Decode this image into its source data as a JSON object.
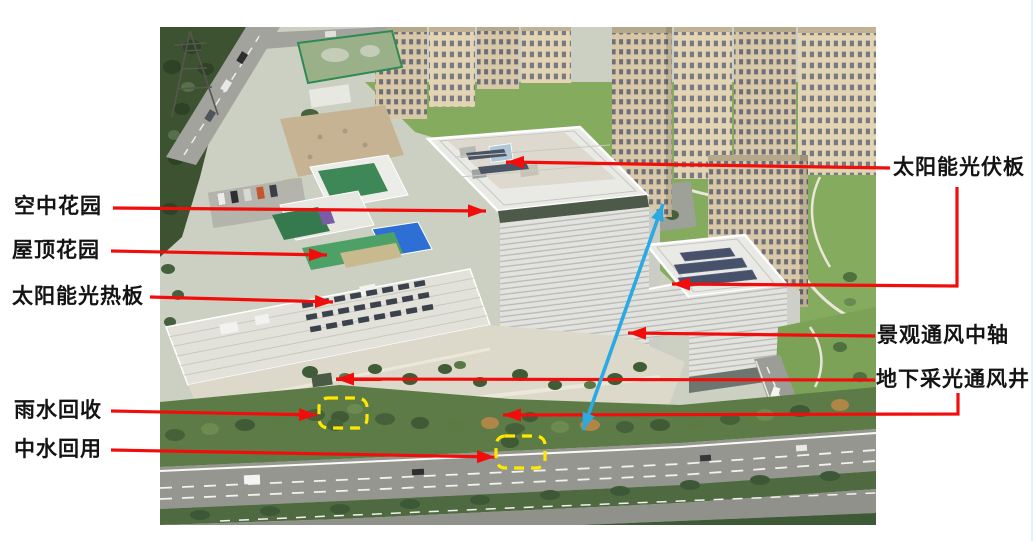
{
  "page": {
    "width": 1035,
    "height": 541,
    "background": "#ffffff"
  },
  "photo": {
    "left": 160,
    "top": 27,
    "width": 716,
    "height": 498,
    "description": "Oblique aerial photo of a green office complex: white louvered office tower and annex with rooftop solar panels, podium with roof gardens, residential high-rises behind, landscaped plaza and boulevard in front"
  },
  "colors": {
    "annotation_red": "#f20d0d",
    "annotation_blue": "#2aa9e2",
    "highlight_yellow": "#ffe800",
    "label_text": "#141414"
  },
  "labels": {
    "left": [
      {
        "id": "sky-garden",
        "text": "空中花园",
        "x": 14,
        "y": 194
      },
      {
        "id": "roof-garden",
        "text": "屋顶花园",
        "x": 12,
        "y": 238
      },
      {
        "id": "solar-thermal",
        "text": "太阳能光热板",
        "x": 12,
        "y": 284
      },
      {
        "id": "rainwater",
        "text": "雨水回收",
        "x": 14,
        "y": 398
      },
      {
        "id": "reclaimed-water",
        "text": "中水回用",
        "x": 14,
        "y": 437
      }
    ],
    "right": [
      {
        "id": "solar-pv",
        "text": "太阳能光伏板",
        "x": 893,
        "y": 155
      },
      {
        "id": "vent-axis",
        "text": "景观通风中轴",
        "x": 877,
        "y": 323
      },
      {
        "id": "daylight-shaft",
        "text": "地下采光通风井",
        "x": 876,
        "y": 367
      }
    ]
  },
  "annotations": {
    "leader_lines": [
      {
        "name": "leader-sky-garden",
        "points": [
          [
            113,
            208
          ],
          [
            486,
            211
          ]
        ]
      },
      {
        "name": "leader-roof-garden",
        "points": [
          [
            111,
            251
          ],
          [
            327,
            255
          ]
        ]
      },
      {
        "name": "leader-solar-thermal",
        "points": [
          [
            150,
            297
          ],
          [
            333,
            302
          ]
        ]
      },
      {
        "name": "leader-rainwater",
        "points": [
          [
            111,
            411
          ],
          [
            317,
            415
          ]
        ]
      },
      {
        "name": "leader-reclaimed-water",
        "points": [
          [
            111,
            450
          ],
          [
            495,
            457
          ]
        ]
      },
      {
        "name": "leader-solar-pv-tower",
        "points": [
          [
            890,
            168
          ],
          [
            506,
            162
          ]
        ]
      },
      {
        "name": "leader-solar-pv-annex",
        "points": [
          [
            957,
            187
          ],
          [
            957,
            286
          ],
          [
            672,
            284
          ]
        ]
      },
      {
        "name": "leader-vent-axis",
        "points": [
          [
            875,
            336
          ],
          [
            628,
            333
          ]
        ]
      },
      {
        "name": "leader-daylight-shaft-1",
        "points": [
          [
            875,
            380
          ],
          [
            336,
            379
          ]
        ]
      },
      {
        "name": "leader-daylight-shaft-2",
        "points": [
          [
            958,
            393
          ],
          [
            958,
            414
          ],
          [
            503,
            415
          ]
        ]
      }
    ],
    "blue_double_arrow": {
      "name": "ventilation-axis-arrow",
      "from": [
        583,
        430
      ],
      "to": [
        663,
        204
      ]
    },
    "dashed_boxes": [
      {
        "name": "highlight-box-rainwater",
        "x": 319,
        "y": 398,
        "w": 48,
        "h": 30
      },
      {
        "name": "highlight-box-reclaimed",
        "x": 496,
        "y": 436,
        "w": 49,
        "h": 32
      }
    ]
  }
}
